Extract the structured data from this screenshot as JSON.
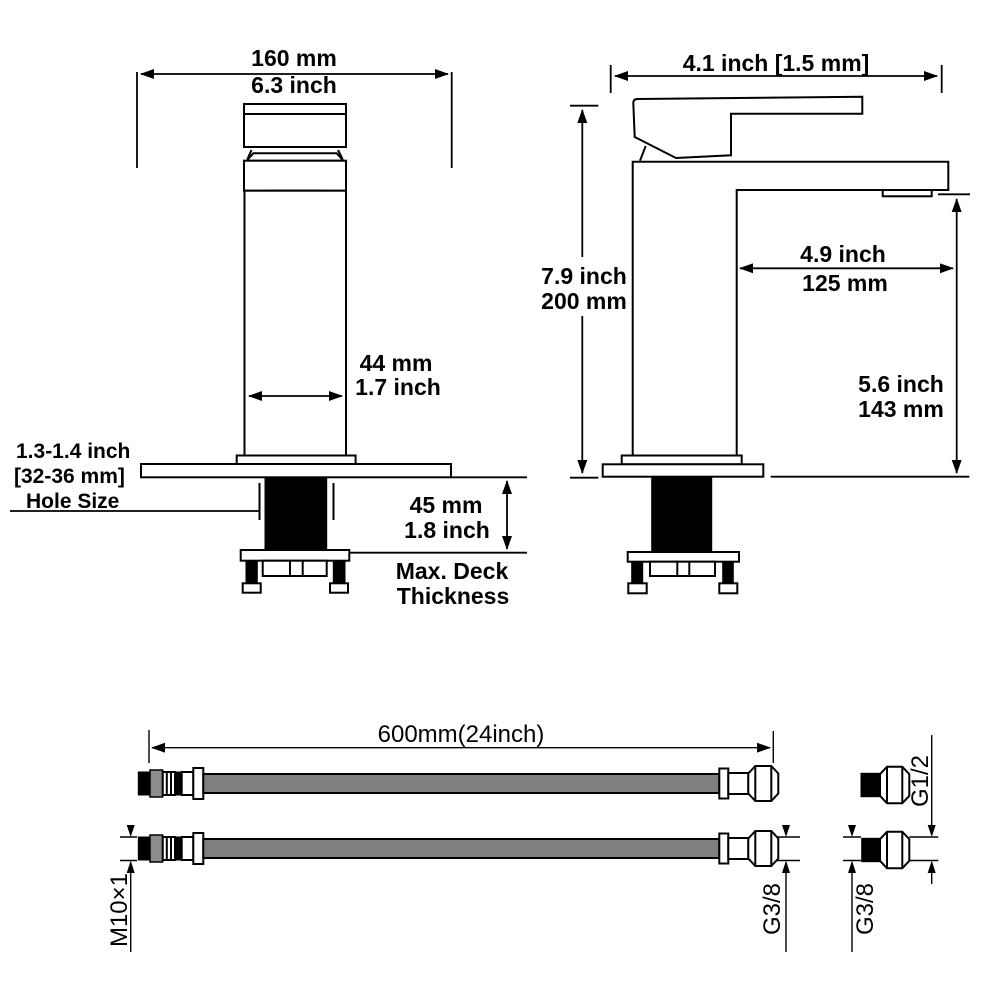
{
  "front": {
    "dim_width_mm": "160 mm",
    "dim_width_in": "6.3 inch",
    "dim_body_mm": "44 mm",
    "dim_body_in": "1.7 inch",
    "hole_line1": "1.3-1.4 inch",
    "hole_line2": "[32-36 mm]",
    "hole_line3": "Hole Size",
    "deck_mm": "45 mm",
    "deck_in": "1.8 inch",
    "deck_label1": "Max. Deck",
    "deck_label2": "Thickness"
  },
  "side": {
    "dim_width": "4.1 inch [1.5 mm]",
    "dim_height_in": "7.9 inch",
    "dim_height_mm": "200 mm",
    "dim_reach_in": "4.9 inch",
    "dim_reach_mm": "125 mm",
    "dim_spout_in": "5.6 inch",
    "dim_spout_mm": "143 mm"
  },
  "hose": {
    "dim_length": "600mm(24inch)",
    "thread_inlet": "M10×1",
    "thread_hose_end": "G3/8",
    "thread_adapter_small": "G3/8",
    "thread_adapter_large": "G1/2"
  },
  "colors": {
    "line": "#000000",
    "hose_tube_gray": "#7f7f7f",
    "connector_gray": "#8c8c8c",
    "background": "#ffffff"
  }
}
